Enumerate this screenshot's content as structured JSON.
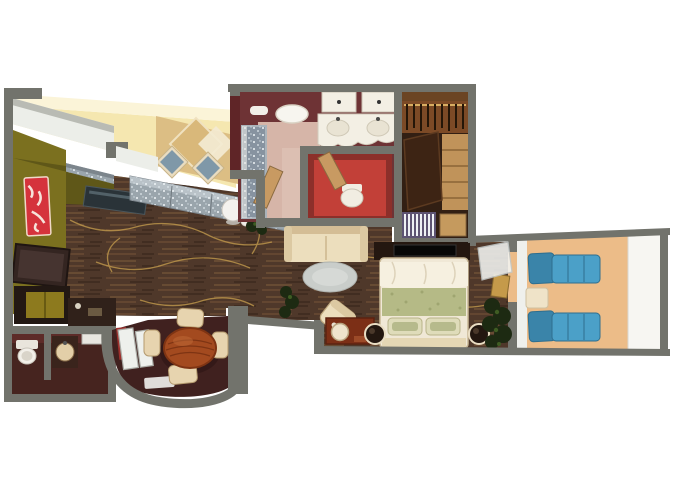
{
  "meta": {
    "type": "floor-plan-rendering",
    "description": "Top-down 3D rendered suite floor plan, no visible text",
    "background": "#ffffff"
  },
  "palette": {
    "wall": "#72736c",
    "wallEdge": "#b9bbb4",
    "whiteWall": "#eceee9",
    "floor": "#4f382a",
    "floorGold": "#c79f4e",
    "yellow": "#f5e7b0",
    "cream": "#fbf4d8",
    "nookTan": "#dcbe84",
    "tableDiamond": "#d9b87a",
    "chairBlue": "#7f98a8",
    "sparkle": "#9aa5ac",
    "sparkleEdge": "#b9c2c8",
    "olive": "#7b701f",
    "artRed": "#d5333c",
    "tvDark": "#342521",
    "slabDark": "#2a3338",
    "cabinetDark": "#221813",
    "cabinetYellow": "#8d7a1e",
    "counterDark": "#30211a",
    "maroon": "#6e3335",
    "maroonWallFace": "#5f2527",
    "bathFloor": "#d6b5a8",
    "vanity": "#f3efe4",
    "redRoom": "#c24038",
    "redRoomDark": "#8c2f2a",
    "doorTan": "#c89a62",
    "shower": "#8793a0",
    "closetBg": "#321f13",
    "closetWood": "#7c4a26",
    "closetShelf": "#c0935a",
    "wardrobe": "#3d2414",
    "drawers": "#5d5372",
    "tanBox": "#c59a5e",
    "diningFloor": "#40211f",
    "diningTable": "#a34a1f",
    "diningTableDark": "#7e3413",
    "chairCream": "#e7d4af",
    "loveseat": "#ecdebd",
    "loveseatEdge": "#d4bd95",
    "rug": "#c9cdca",
    "bedSheet": "#f0e8d6",
    "bedSage": "#b5ba86",
    "pillow": "#dfdcba",
    "pillowGreen": "#a8af7c",
    "nightstand": "#231710",
    "nightstandRing": "#e9ddc3",
    "deskRed": "#7c2f16",
    "stool": "#efe4cd",
    "deck": "#ecbc88",
    "railing": "#f7f6f2",
    "lounger": "#4ba0c8",
    "loungerDark": "#3a84a9",
    "plant": "#1d2a12",
    "plantLight": "#3f5c23",
    "lamp": "#f4f2ee"
  },
  "rooms": [
    {
      "name": "living-room",
      "furniture": [
        "sectional-sofa",
        "window-nook-diamond-table",
        "two-nook-chairs",
        "wall-art-red",
        "tv-panel",
        "console-slab",
        "bar-cabinet",
        "sphere-lamp",
        "plants"
      ]
    },
    {
      "name": "dining-bay",
      "furniture": [
        "round-wood-table",
        "four-cream-chairs",
        "curved-bay-wall",
        "white-door-panels"
      ]
    },
    {
      "name": "guest-bathroom",
      "furniture": [
        "toilet",
        "round-sink"
      ]
    },
    {
      "name": "master-bathroom",
      "furniture": [
        "double-sink-vanity",
        "oval-ceiling-light",
        "shower",
        "red-water-closet",
        "tan-doors"
      ]
    },
    {
      "name": "walk-in-closet",
      "furniture": [
        "hanger-rod",
        "shelving",
        "wardrobe",
        "slatted-drawers"
      ]
    },
    {
      "name": "bedroom",
      "furniture": [
        "bed-sage-runner",
        "two-round-nightstands",
        "loveseat",
        "oval-rug",
        "armchair",
        "vanity-desk",
        "stool",
        "tv-console",
        "glass-door",
        "plant"
      ]
    },
    {
      "name": "balcony",
      "furniture": [
        "lounger-1",
        "lounger-2",
        "side-table",
        "white-railing"
      ]
    }
  ]
}
